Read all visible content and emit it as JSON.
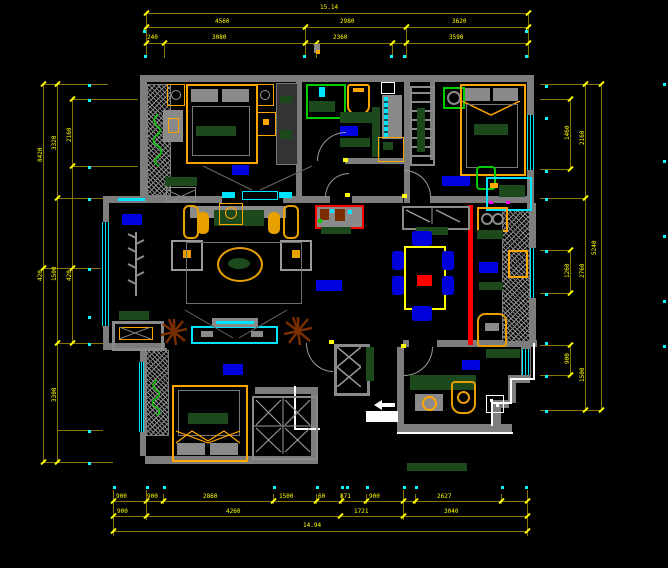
{
  "drawing": {
    "type": "residential-floor-plan",
    "background": "#000000",
    "palette": {
      "wall": "#7d7d7d",
      "dim_line": "#8a7500",
      "dim_text": "#ffff00",
      "axis_marker": "#00ffff",
      "window": "#00e5ff",
      "furniture_accent": "#ffa500",
      "room_label_block": "#0000e0",
      "greenery": "#00cc00",
      "dark_green": "#1d4a1d",
      "slider_red": "#ff0000",
      "dining_table_yellow": "#ffff00",
      "plant_brown": "#7a2e00",
      "entry_white": "#ffffff"
    }
  },
  "dims": {
    "top": {
      "total": "15.14",
      "row2": [
        "4560",
        "2980",
        "3620"
      ],
      "row3": [
        "240",
        "3080",
        "2360",
        "3590"
      ]
    },
    "bottom": {
      "row1": [
        "900",
        "900",
        "2860",
        "1500",
        "60",
        "871",
        "900",
        "2627"
      ],
      "row2": [
        "900",
        "4260",
        "1721",
        "3040"
      ],
      "total": "14.94"
    },
    "left": [
      "8420",
      "3320",
      "2160",
      "420",
      "1500",
      "420",
      "3300"
    ],
    "right": [
      "1460",
      "2160",
      "5240",
      "1260",
      "2760",
      "900",
      "1500"
    ]
  }
}
